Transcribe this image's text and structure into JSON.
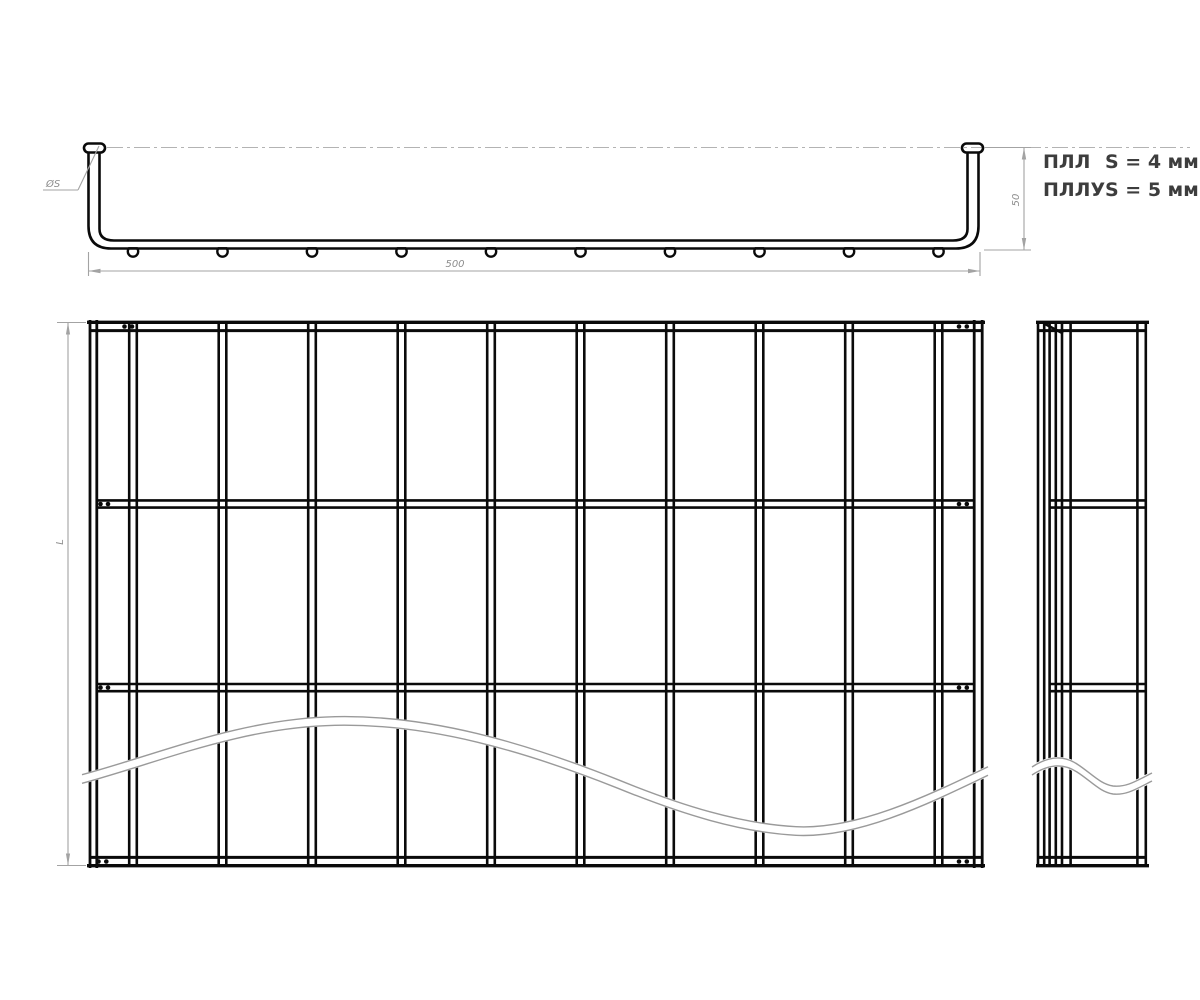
{
  "annotation": {
    "rows": [
      {
        "name": "ПЛЛ",
        "value": "S = 4 мм"
      },
      {
        "name": "ПЛЛУ",
        "value": "S = 5 мм"
      }
    ]
  },
  "dimensions": {
    "profile_width": "500",
    "profile_height": "50",
    "front_length": "L",
    "wire_diameter": "ØS"
  },
  "colors": {
    "line": "#0a0a0a",
    "dimension": "#a3a3a3",
    "dimension_text": "#8d8d8d",
    "break_line": "#9a9a9a",
    "annotation_text": "#3d3d3d",
    "background": "#ffffff"
  }
}
